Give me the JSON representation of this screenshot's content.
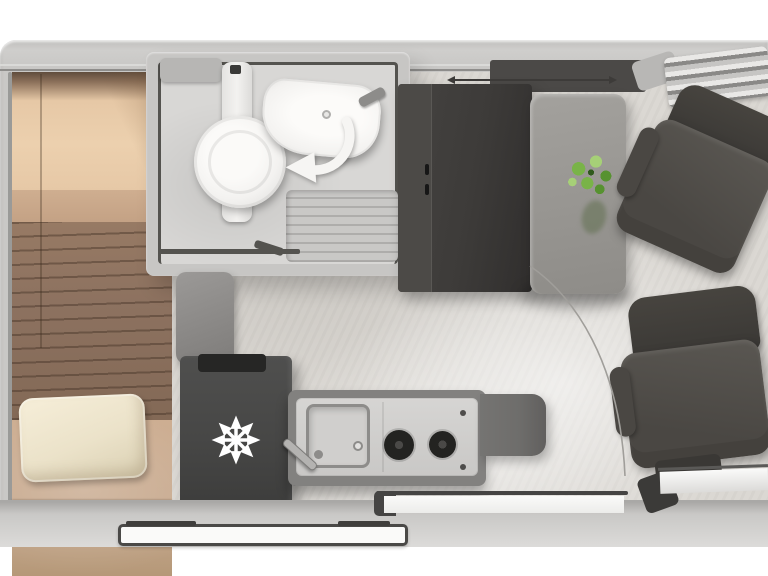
{
  "scene": {
    "title": "Campervan floor plan — top view",
    "areas": {
      "bed": "rear transverse bed with wood base and pillow",
      "bathroom": "wet room with toilet, swivel washbasin and shower tray",
      "wardrobe": "tall dark cabinet with door handles",
      "dinette": "pedestal table with plant between two swivel cab seats",
      "kitchen": "fridge with snowflake marker, sink, two-burner hob, worktop flap",
      "entry": "sliding-door opening with exterior entry step"
    },
    "icons": {
      "snowflake-icon": "refrigerator marker",
      "swivel-arrow-icon": "washbasin rotation direction",
      "plant-icon": "table decoration",
      "burner-icon": "gas hob ring (x2)",
      "door-arc-icon": "sliding door travel path"
    }
  },
  "colors": {
    "bg": "#ffffff",
    "wall": "#c9c8c6",
    "wall_light": "#dcdbd9",
    "wall_dark": "#8f8e8c",
    "trim": "#8e8d8b",
    "floor": "#dbd8d3",
    "bed_peach": "#e6c8a6",
    "bed_tan": "#c3a184",
    "bed_wood": "#8d7260",
    "bed_lower": "#c7a98e",
    "pillow": "#ebe2c9",
    "bath_shell": "#c7c6c4",
    "bath_floor": "#d8d7d5",
    "bath_outline": "#54534f",
    "fixture": "#f3f2f0",
    "shower_a": "#c9c8c6",
    "shower_b": "#aeadab",
    "cabinet": "#3d3b39",
    "cabinet_strip": "#4c4a47",
    "sideboard": "#4b4947",
    "fridge": "#474746",
    "fridge_slot": "#262625",
    "counter_body": "#82817f",
    "counter_top": "#d6d5d3",
    "sink": "#d0cfcd",
    "metal": "#8d8c8a",
    "burner": "#232321",
    "flap": "#6e6d6b",
    "table_a": "#a3a19d",
    "table_b": "#8e8c88",
    "plant_a": "#79b348",
    "plant_b": "#579230",
    "plant_c": "#a6d077",
    "seat": "#4a4743",
    "seat_light": "#5a5752",
    "seat_dark": "#3a3835",
    "arc": "#a09e9a",
    "door_dark": "#454443",
    "white": "#fafaf9",
    "step_border": "#4a4947"
  }
}
